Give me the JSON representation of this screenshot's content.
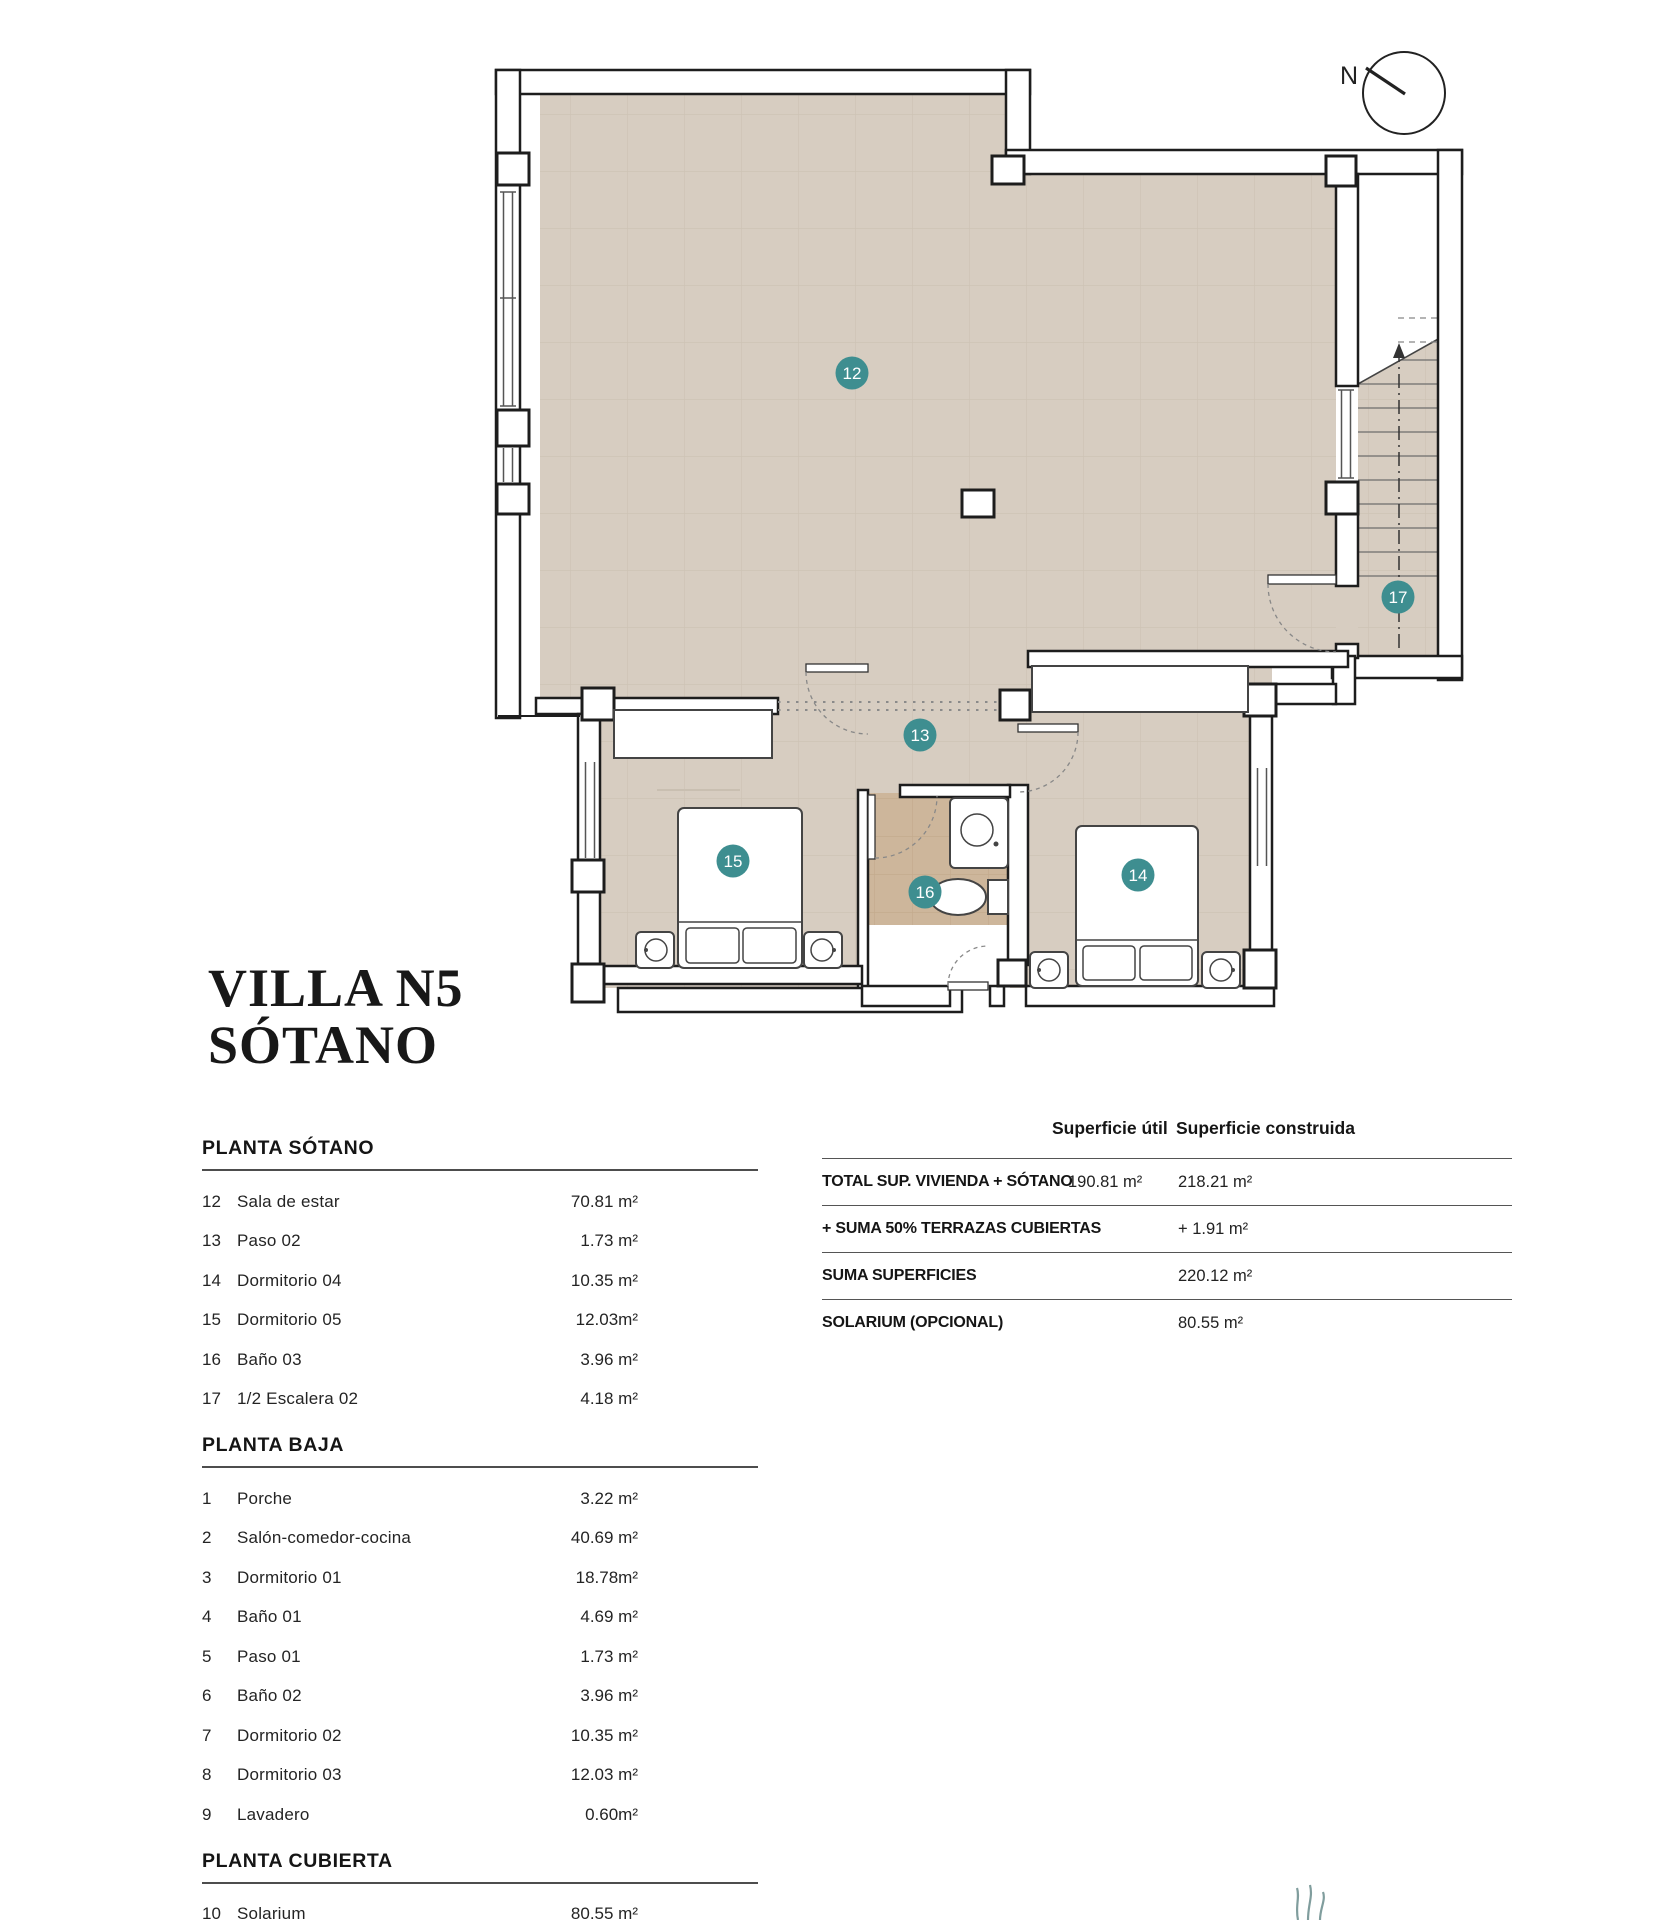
{
  "title": {
    "line1": "VILLA N5",
    "line2": "SÓTANO"
  },
  "compass": {
    "label": "N"
  },
  "plan": {
    "badges": [
      {
        "num": "12",
        "x": 852,
        "y": 373
      },
      {
        "num": "13",
        "x": 920,
        "y": 735
      },
      {
        "num": "14",
        "x": 1138,
        "y": 875
      },
      {
        "num": "15",
        "x": 733,
        "y": 861
      },
      {
        "num": "16",
        "x": 925,
        "y": 892
      },
      {
        "num": "17",
        "x": 1398,
        "y": 597
      }
    ],
    "colors": {
      "floor": "#d7cdc1",
      "floor_grid": "#cdc2b4",
      "bath_floor": "#cdb69b",
      "bath_grid": "#c3aa8b",
      "wall_line": "#1d1d1d",
      "badge": "#3e8e90"
    }
  },
  "left_table": {
    "sections": [
      {
        "heading": "PLANTA SÓTANO",
        "rows": [
          {
            "num": "12",
            "name": "Sala de estar",
            "area": "70.81 m²"
          },
          {
            "num": "13",
            "name": "Paso 02",
            "area": "1.73 m²"
          },
          {
            "num": "14",
            "name": "Dormitorio 04",
            "area": "10.35 m²"
          },
          {
            "num": "15",
            "name": "Dormitorio 05",
            "area": "12.03m²"
          },
          {
            "num": "16",
            "name": "Baño 03",
            "area": "3.96 m²"
          },
          {
            "num": "17",
            "name": "1/2 Escalera 02",
            "area": "4.18 m²"
          }
        ]
      },
      {
        "heading": "PLANTA BAJA",
        "rows": [
          {
            "num": "1",
            "name": "Porche",
            "area": "3.22 m²"
          },
          {
            "num": "2",
            "name": "Salón-comedor-cocina",
            "area": "40.69 m²"
          },
          {
            "num": "3",
            "name": "Dormitorio 01",
            "area": "18.78m²"
          },
          {
            "num": "4",
            "name": "Baño 01",
            "area": "4.69 m²"
          },
          {
            "num": "5",
            "name": "Paso 01",
            "area": "1.73 m²"
          },
          {
            "num": "6",
            "name": "Baño 02",
            "area": "3.96 m²"
          },
          {
            "num": "7",
            "name": "Dormitorio 02",
            "area": "10.35 m²"
          },
          {
            "num": "8",
            "name": "Dormitorio 03",
            "area": "12.03 m²"
          },
          {
            "num": "9",
            "name": "Lavadero",
            "area": "0.60m²"
          }
        ]
      },
      {
        "heading": "PLANTA CUBIERTA",
        "rows": [
          {
            "num": "10",
            "name": "Solarium",
            "area": "80.55 m²"
          },
          {
            "num": "11",
            "name": "Cubierta de grava",
            "area": "27.53 m²"
          }
        ]
      }
    ]
  },
  "summary_table": {
    "col_util": "Superficie útil",
    "col_constr": "Superficie construida",
    "rows": [
      {
        "label": "TOTAL SUP. VIVIENDA + SÓTANO",
        "util": "190.81  m²",
        "constr": "218.21 m²"
      },
      {
        "label": "+ SUMA 50% TERRAZAS CUBIERTAS",
        "util": "",
        "constr": "+ 1.91 m²"
      },
      {
        "label": "SUMA SUPERFICIES",
        "util": "",
        "constr": "220.12 m²"
      },
      {
        "label": "SOLARIUM (OPCIONAL)",
        "util": "",
        "constr": "80.55 m²"
      }
    ]
  }
}
